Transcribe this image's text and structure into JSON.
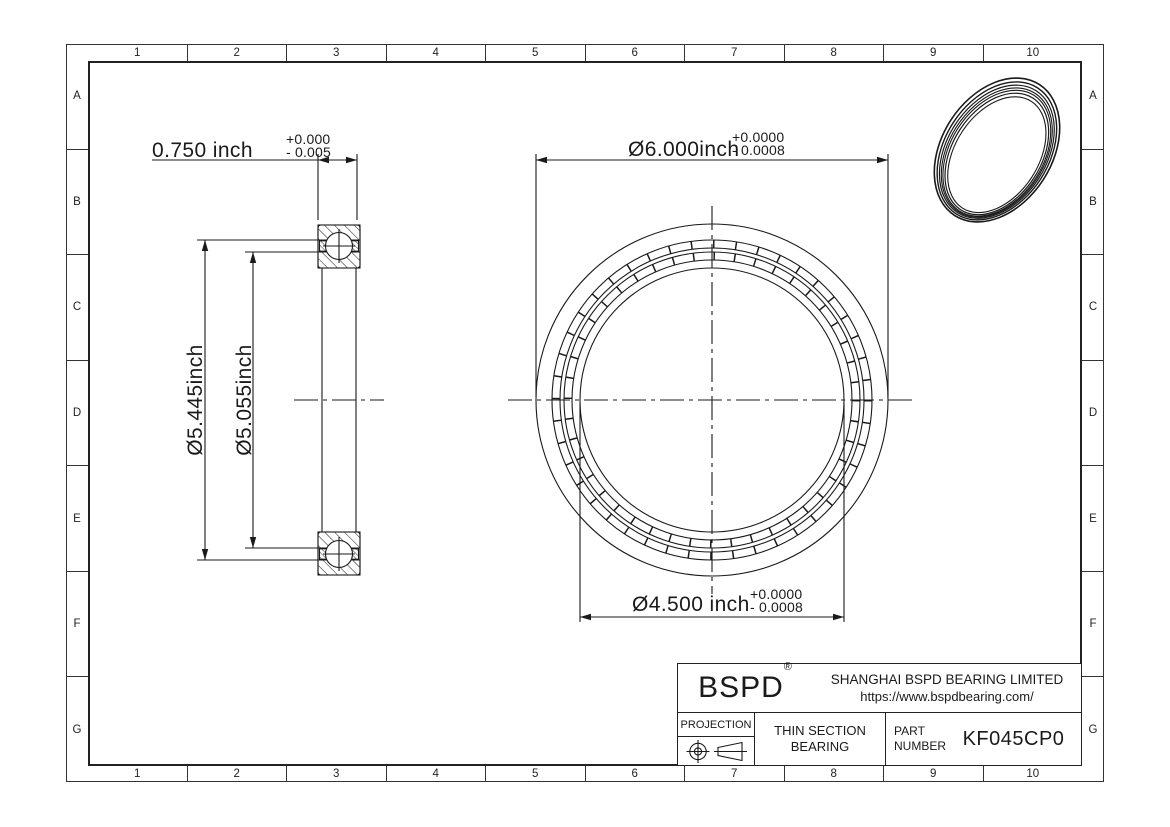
{
  "drawing": {
    "grid": {
      "columns": [
        "1",
        "2",
        "3",
        "4",
        "5",
        "6",
        "7",
        "8",
        "9",
        "10"
      ],
      "rows": [
        "A",
        "B",
        "C",
        "D",
        "E",
        "F",
        "G"
      ]
    },
    "dimensions": {
      "width": {
        "value": "0.750 inch",
        "tol_plus": "+0.000",
        "tol_minus": "- 0.005"
      },
      "outer_diameter": {
        "value": "Ø6.000inch",
        "tol_plus": "+0.0000",
        "tol_minus": "- 0.0008"
      },
      "bore_diameter": {
        "value": "Ø4.500 inch",
        "tol_plus": "+0.0000",
        "tol_minus": "- 0.0008"
      },
      "outer_race_diameter": {
        "value": "Ø5.445inch"
      },
      "inner_race_diameter": {
        "value": "Ø5.055inch"
      }
    },
    "title_block": {
      "logo": "BSPD",
      "registered": "®",
      "company": "SHANGHAI BSPD BEARING LIMITED",
      "website": "https://www.bspdbearing.com/",
      "projection_label": "PROJECTION",
      "product_line1": "THIN SECTION",
      "product_line2": "BEARING",
      "part_label_line1": "PART",
      "part_label_line2": "NUMBER",
      "part_number": "KF045CP0"
    },
    "colors": {
      "line": "#1a1a1a",
      "background": "#ffffff"
    }
  }
}
